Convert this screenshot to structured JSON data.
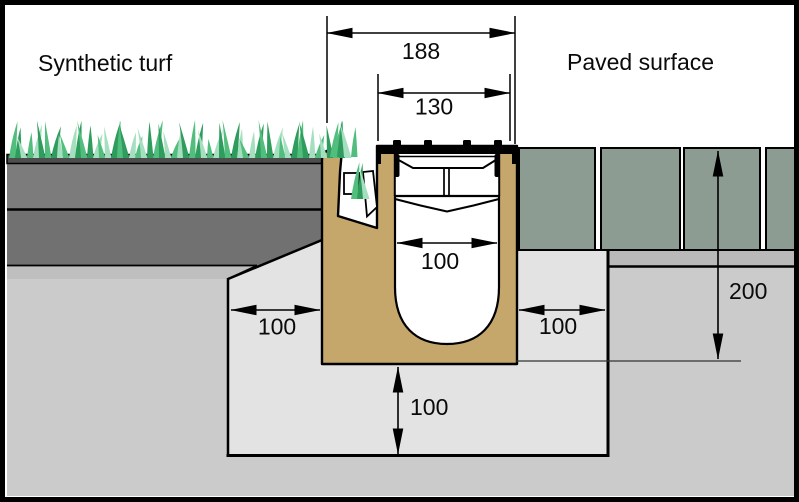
{
  "labels": {
    "left_area": "Synthetic turf",
    "right_area": "Paved surface"
  },
  "dimensions": {
    "overall_width": "188",
    "grate_width": "130",
    "channel_inner_width": "100",
    "surround_left_width": "100",
    "surround_right_width": "100",
    "base_thickness": "100",
    "pavement_depth": "200"
  },
  "colors": {
    "concrete_surround": "#C6A76B",
    "paver": "#8C9C92",
    "turf_backing": "#4E4E4E",
    "base_layer_upper": "#7C7C7C",
    "base_layer_lower": "#717171",
    "bedding_band_left": "#BFBFBF",
    "bedding_band_right": "#B9B9B9",
    "ground": "#CBCBCB",
    "trench_backfill": "#E3E3E3",
    "grass_dark": "#2E9C5C",
    "grass_mid": "#52BE7E",
    "grass_light": "#A5DFC0",
    "outline": "#000000"
  }
}
